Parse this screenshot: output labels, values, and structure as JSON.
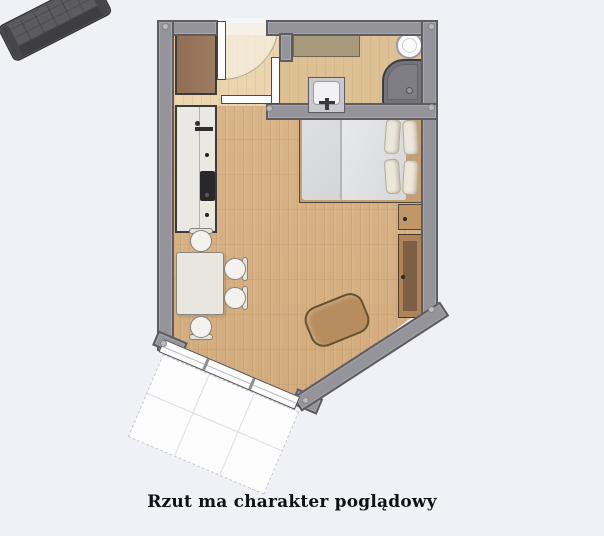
{
  "caption": {
    "text": "Rzut ma charakter poglądowy"
  },
  "palette": {
    "background": "#eff1f6",
    "wall": "#94949a",
    "wall_outline": "#5c5c61",
    "floor_wood": "#d7b084",
    "floor_hall": "#ead5af",
    "floor_bath": "#ddc195",
    "furniture_wood": "#b78d5f",
    "sofa_dark": "#56565a",
    "balcony": "#fdfdfe"
  },
  "rooms": [
    {
      "name": "entry-hall"
    },
    {
      "name": "bathroom"
    },
    {
      "name": "living-room-with-kitchenette"
    },
    {
      "name": "balcony"
    }
  ],
  "furniture": [
    {
      "name": "wardrobe"
    },
    {
      "name": "entry-door"
    },
    {
      "name": "interior-door"
    },
    {
      "name": "bathroom-door"
    },
    {
      "name": "bathroom-counter"
    },
    {
      "name": "toilet"
    },
    {
      "name": "shower"
    },
    {
      "name": "washbasin"
    },
    {
      "name": "kitchen-unit-with-cooktop-and-sink"
    },
    {
      "name": "dining-table"
    },
    {
      "name": "dining-chair",
      "count": 4
    },
    {
      "name": "double-bed-with-pillows"
    },
    {
      "name": "nightstand"
    },
    {
      "name": "desk-sideboard"
    },
    {
      "name": "coffee-table"
    },
    {
      "name": "sofa"
    },
    {
      "name": "window-segment",
      "count": 3
    }
  ]
}
